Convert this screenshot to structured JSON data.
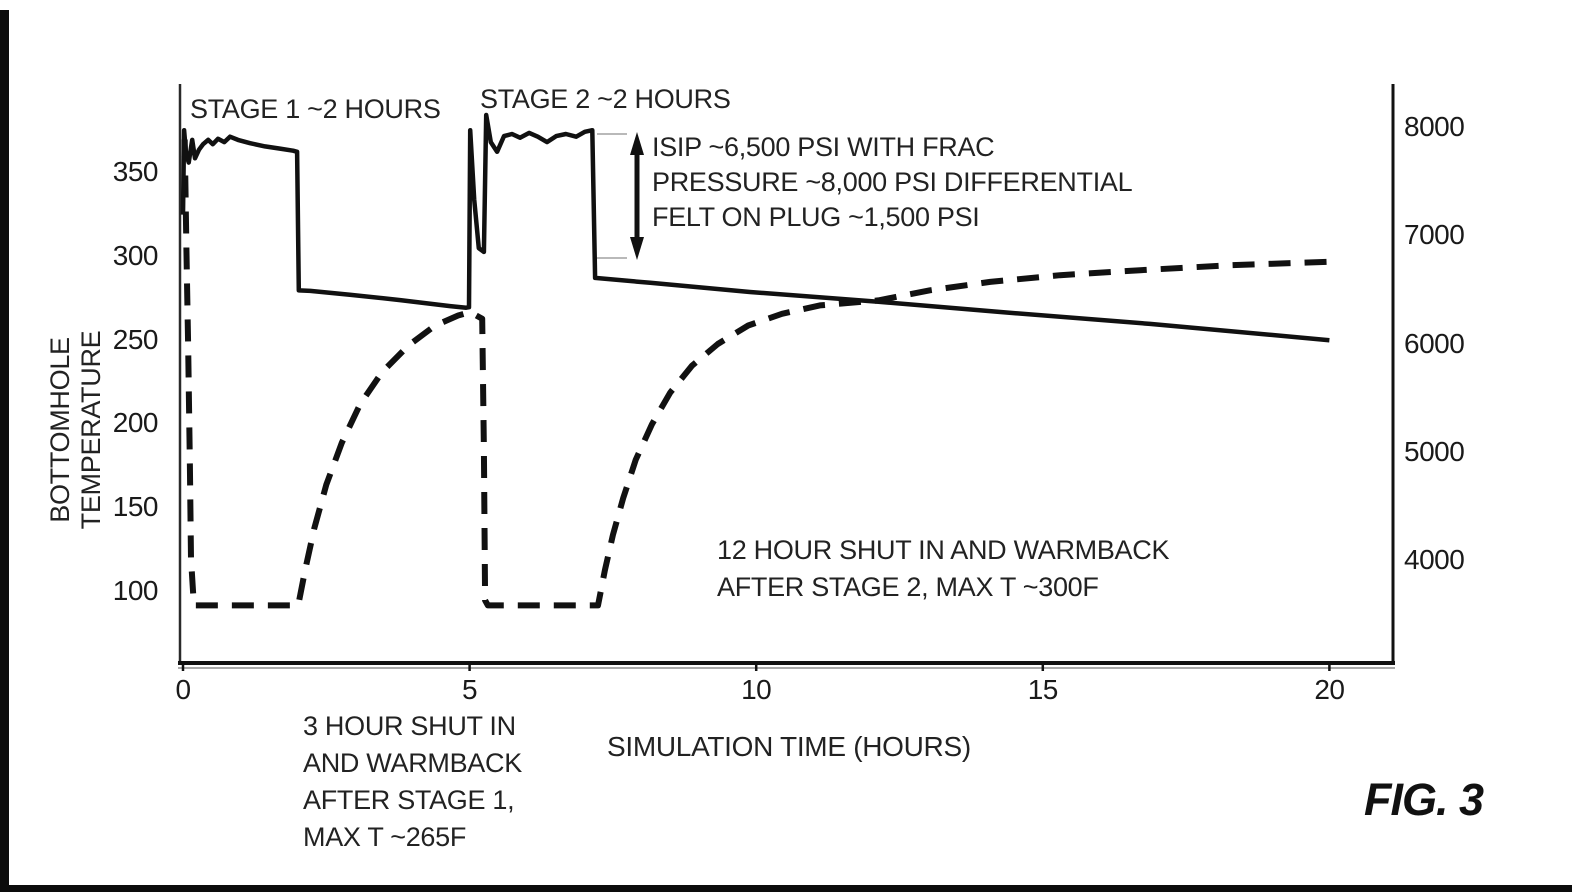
{
  "figure_label": "FIG. 3",
  "chart_data": {
    "type": "line",
    "title": "",
    "xlabel": "SIMULATION TIME (HOURS)",
    "ylabel_left": "BOTTOMHOLE\nTEMPERATURE",
    "ylabel_right": "",
    "grid": false,
    "legend": "none",
    "x_ticks": [
      0,
      5,
      10,
      15,
      20
    ],
    "y_left_ticks": [
      350,
      300,
      250,
      200,
      150,
      100
    ],
    "y_right_ticks": [
      8000,
      7000,
      6000,
      5000,
      4000
    ],
    "x_range_hours": [
      0,
      21.1
    ],
    "y_left_range_degF": [
      58,
      402
    ],
    "y_right_range_psi": [
      3060,
      8400
    ],
    "series": [
      {
        "name": "bottomhole-temperature-warmback",
        "axis": "left",
        "unit": "degF",
        "line_style": "dashed",
        "color": "#111111",
        "points": [
          [
            0.03,
            370
          ],
          [
            0.06,
            305
          ],
          [
            0.09,
            245
          ],
          [
            0.12,
            175
          ],
          [
            0.14,
            120
          ],
          [
            0.19,
            92
          ],
          [
            2.01,
            92
          ],
          [
            2.13,
            113
          ],
          [
            2.29,
            138
          ],
          [
            2.5,
            164
          ],
          [
            2.77,
            189
          ],
          [
            3.09,
            212
          ],
          [
            3.47,
            231
          ],
          [
            3.93,
            247
          ],
          [
            4.4,
            259
          ],
          [
            4.8,
            265
          ],
          [
            5.01,
            267
          ],
          [
            5.22,
            263
          ],
          [
            5.25,
            185
          ],
          [
            5.27,
            95
          ],
          [
            5.32,
            92
          ],
          [
            7.24,
            92
          ],
          [
            7.36,
            113
          ],
          [
            7.5,
            134
          ],
          [
            7.68,
            156
          ],
          [
            7.9,
            179
          ],
          [
            8.18,
            200
          ],
          [
            8.5,
            219
          ],
          [
            8.88,
            235
          ],
          [
            9.33,
            248
          ],
          [
            9.86,
            259
          ],
          [
            10.45,
            266
          ],
          [
            11.11,
            271
          ],
          [
            12.13,
            274
          ],
          [
            13.03,
            280
          ],
          [
            14.08,
            285
          ],
          [
            15.3,
            289
          ],
          [
            16.7,
            292
          ],
          [
            18.27,
            295
          ],
          [
            20.0,
            297
          ]
        ]
      },
      {
        "name": "bottomhole-pressure",
        "axis": "right",
        "unit": "psi",
        "line_style": "solid",
        "color": "#111111",
        "points": [
          [
            0.0,
            7200
          ],
          [
            0.02,
            7980
          ],
          [
            0.05,
            7780
          ],
          [
            0.1,
            7680
          ],
          [
            0.16,
            7890
          ],
          [
            0.21,
            7720
          ],
          [
            0.28,
            7800
          ],
          [
            0.35,
            7850
          ],
          [
            0.44,
            7890
          ],
          [
            0.52,
            7850
          ],
          [
            0.61,
            7900
          ],
          [
            0.72,
            7870
          ],
          [
            0.82,
            7920
          ],
          [
            0.96,
            7890
          ],
          [
            1.17,
            7860
          ],
          [
            1.43,
            7830
          ],
          [
            1.69,
            7810
          ],
          [
            1.92,
            7790
          ],
          [
            1.99,
            7780
          ],
          [
            2.02,
            6500
          ],
          [
            2.22,
            6495
          ],
          [
            2.91,
            6460
          ],
          [
            3.79,
            6410
          ],
          [
            4.66,
            6355
          ],
          [
            4.94,
            6340
          ],
          [
            4.99,
            6345
          ],
          [
            5.01,
            7980
          ],
          [
            5.08,
            7340
          ],
          [
            5.16,
            6890
          ],
          [
            5.25,
            6855
          ],
          [
            5.29,
            8120
          ],
          [
            5.37,
            7870
          ],
          [
            5.48,
            7780
          ],
          [
            5.6,
            7925
          ],
          [
            5.74,
            7945
          ],
          [
            5.88,
            7910
          ],
          [
            6.04,
            7955
          ],
          [
            6.19,
            7920
          ],
          [
            6.35,
            7870
          ],
          [
            6.51,
            7925
          ],
          [
            6.68,
            7945
          ],
          [
            6.86,
            7920
          ],
          [
            7.01,
            7965
          ],
          [
            7.14,
            7980
          ],
          [
            7.19,
            6615
          ],
          [
            8.15,
            6570
          ],
          [
            9.89,
            6485
          ],
          [
            12.13,
            6395
          ],
          [
            14.26,
            6300
          ],
          [
            16.87,
            6190
          ],
          [
            20.0,
            6040
          ]
        ]
      }
    ],
    "annotations": {
      "stage1": "STAGE 1 ~2 HOURS",
      "stage2": "STAGE 2 ~2 HOURS",
      "isip": "ISIP ~6,500 PSI WITH FRAC\nPRESSURE ~8,000 PSI DIFFERENTIAL\nFELT ON PLUG ~1,500 PSI",
      "shut_in_12hr": "12 HOUR SHUT IN AND WARMBACK\nAFTER STAGE 2, MAX T ~300F",
      "shut_in_3hr": "3 HOUR SHUT IN\nAND WARMBACK\nAFTER STAGE 1,\nMAX T ~265F"
    }
  }
}
